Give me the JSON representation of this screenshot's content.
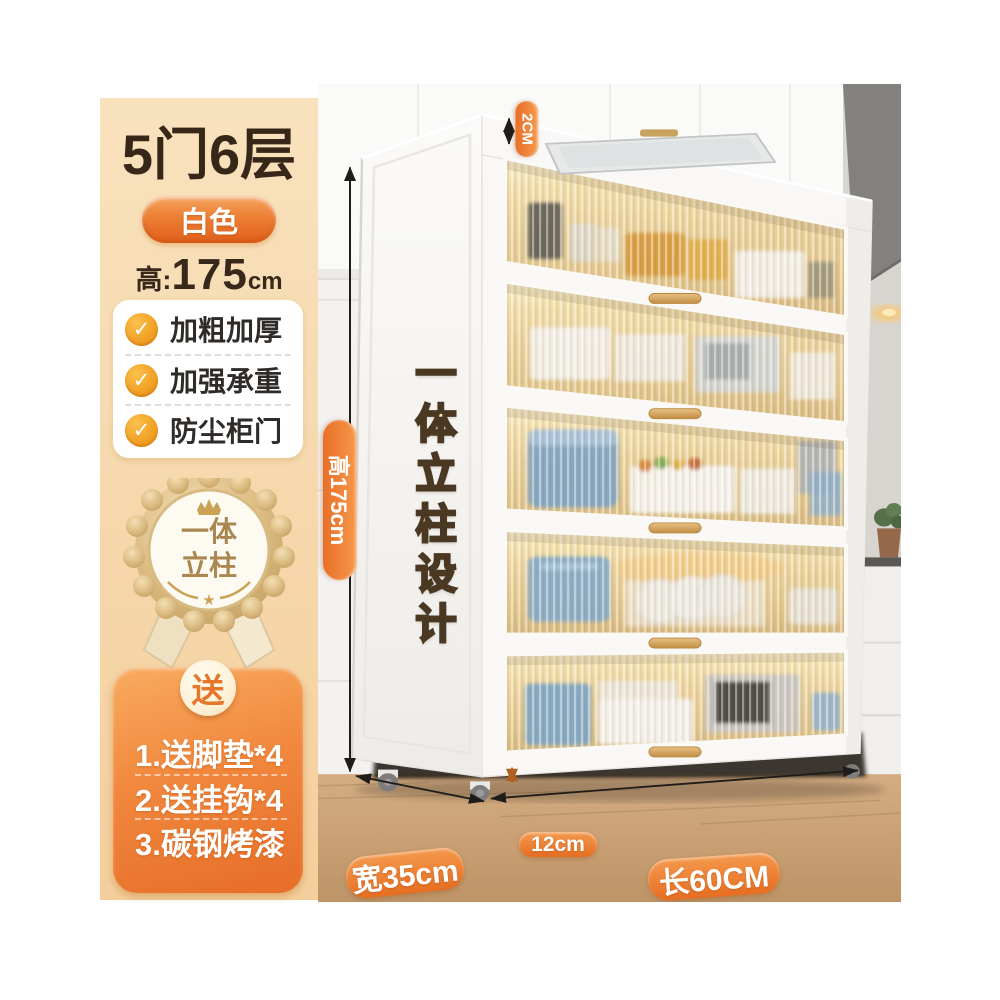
{
  "page": {
    "background": "#ffffff"
  },
  "sidebar": {
    "title": "5门6层",
    "color_pill": {
      "label": "白色",
      "bg": "#ec7f33"
    },
    "height_spec": {
      "prefix": "高:",
      "value": "175",
      "unit": "cm"
    },
    "features": [
      {
        "icon": "check-icon",
        "label": "加粗加厚"
      },
      {
        "icon": "check-icon",
        "label": "加强承重"
      },
      {
        "icon": "check-icon",
        "label": "防尘柜门"
      }
    ],
    "medal": {
      "line1": "一体",
      "line2": "立柱",
      "star": "★",
      "crown_icon": "crown-icon"
    },
    "gift": {
      "badge": "送",
      "items": [
        {
          "label": "1.送脚垫*4"
        },
        {
          "label": "2.送挂钩*4"
        },
        {
          "label": "3.碳钢烤漆"
        }
      ]
    }
  },
  "photo": {
    "vertical_design_text": "一体立柱设计",
    "labels": {
      "height": "高175cm",
      "top_gap": "2CM",
      "bottom_gap": "12cm",
      "width": "宽35cm",
      "length": "长60CM"
    },
    "accent_orange": "#ed7e30"
  }
}
